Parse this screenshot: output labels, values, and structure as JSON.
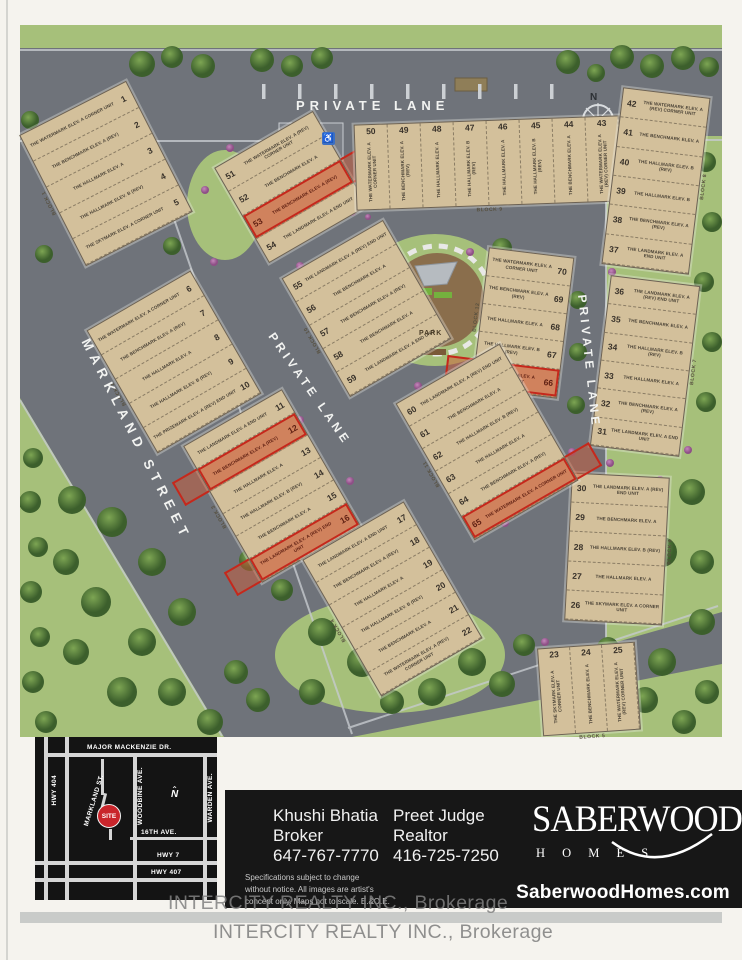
{
  "map": {
    "streets": {
      "private_lane_top": "PRIVATE LANE",
      "markland_street": "MARKLAND STREET",
      "private_lane_center": "PRIVATE LANE",
      "private_lane_right": "PRIVATE LANE"
    },
    "park_label": "PARK",
    "compass_label": "N",
    "blocks": [
      {
        "id": "b1",
        "label": "BLOCK 1",
        "lots": [
          {
            "n": "1",
            "model": "THE WATERMARK ELEV. A CORNER UNIT"
          },
          {
            "n": "2",
            "model": "THE BENCHMARK ELEV. A (REV)"
          },
          {
            "n": "3",
            "model": "THE HALLMARK ELEV. A"
          },
          {
            "n": "4",
            "model": "THE HALLMARK ELEV. B (REV)"
          },
          {
            "n": "5",
            "model": "THE SKYMARK ELEV. A CORNER UNIT"
          }
        ]
      },
      {
        "id": "b10",
        "label": "",
        "lots": [
          {
            "n": "51",
            "model": "THE WATERMARK ELEV. A (REV) CORNER UNIT"
          },
          {
            "n": "52",
            "model": "THE BENCHMARK ELEV. A"
          },
          {
            "n": "53",
            "model": "THE BENCHMARK ELEV. A (REV)",
            "hl": true
          },
          {
            "n": "54",
            "model": "THE LANDMARK ELEV. A END UNIT"
          }
        ]
      },
      {
        "id": "b9",
        "label": "BLOCK 9",
        "lots": [
          {
            "n": "50",
            "model": "THE WATERMARK ELEV. A CORNER UNIT"
          },
          {
            "n": "49",
            "model": "THE BENCHMARK ELEV. A (REV)"
          },
          {
            "n": "48",
            "model": "THE HALLMARK ELEV. A"
          },
          {
            "n": "47",
            "model": "THE HALLMARK ELEV. B (REV)"
          },
          {
            "n": "46",
            "model": "THE HALLMARK ELEV. A"
          },
          {
            "n": "45",
            "model": "THE HALLMARK ELEV. B (REV)"
          },
          {
            "n": "44",
            "model": "THE BENCHMARK ELEV. A"
          },
          {
            "n": "43",
            "model": "THE WATERMARK ELEV. A (REV) CORNER UNIT"
          }
        ]
      },
      {
        "id": "b6",
        "label": "BLOCK 8",
        "lots": [
          {
            "n": "42",
            "model": "THE WATERMARK ELEV. A (REV) CORNER UNIT"
          },
          {
            "n": "41",
            "model": "THE BENCHMARK ELEV. A"
          },
          {
            "n": "40",
            "model": "THE HALLMARK ELEV. B (REV)"
          },
          {
            "n": "39",
            "model": "THE HALLMARK ELEV. B"
          },
          {
            "n": "38",
            "model": "THE BENCHMARK ELEV. A (REV)"
          },
          {
            "n": "37",
            "model": "THE LANDMARK ELEV. A END UNIT"
          }
        ]
      },
      {
        "id": "b12",
        "label": "BLOCK 12",
        "lots": [
          {
            "n": "70",
            "model": "THE WATERMARK ELEV. A CORNER UNIT"
          },
          {
            "n": "69",
            "model": "THE BENCHMARK ELEV. A (REV)"
          },
          {
            "n": "68",
            "model": "THE HALLMARK ELEV. A"
          },
          {
            "n": "67",
            "model": "THE HALLMARK ELEV. B (REV)"
          },
          {
            "n": "66",
            "model": "THE SKYMARK ELEV. A CORNER UNIT",
            "hl": true
          }
        ]
      },
      {
        "id": "b7",
        "label": "BLOCK 7",
        "lots": [
          {
            "n": "36",
            "model": "THE LANDMARK ELEV. A (REV) END UNIT"
          },
          {
            "n": "35",
            "model": "THE BENCHMARK ELEV. A"
          },
          {
            "n": "34",
            "model": "THE HALLMARK ELEV. B (REV)"
          },
          {
            "n": "33",
            "model": "THE HALLMARK ELEV. A"
          },
          {
            "n": "32",
            "model": "THE BENCHMARK ELEV. A (REV)"
          },
          {
            "n": "31",
            "model": "THE LANDMARK ELEV. A END UNIT"
          }
        ]
      },
      {
        "id": "b8",
        "label": "BLOCK 6",
        "lots": [
          {
            "n": "30",
            "model": "THE LANDMARK ELEV. A (REV) END UNIT"
          },
          {
            "n": "29",
            "model": "THE BENCHMARK ELEV. A"
          },
          {
            "n": "28",
            "model": "THE HALLMARK ELEV. B (REV)"
          },
          {
            "n": "27",
            "model": "THE HALLMARK ELEV. A"
          },
          {
            "n": "26",
            "model": "THE SKYMARK ELEV. A CORNER UNIT"
          }
        ]
      },
      {
        "id": "b2",
        "label": "BLOCK 2",
        "lots": [
          {
            "n": "6",
            "model": "THE WATERMARK ELEV. A CORNER UNIT"
          },
          {
            "n": "7",
            "model": "THE BENCHMARK ELEV. A (REV)"
          },
          {
            "n": "8",
            "model": "THE HALLMARK ELEV. A"
          },
          {
            "n": "9",
            "model": "THE HALLMARK ELEV. B (REV)"
          },
          {
            "n": "10",
            "model": "THE PRIZEMARK ELEV. A (REV) END UNIT"
          }
        ]
      },
      {
        "id": "b55",
        "label": "BLOCK 10",
        "lots": [
          {
            "n": "55",
            "model": "THE LANDMARK ELEV. A (REV) END UNIT"
          },
          {
            "n": "56",
            "model": "THE BENCHMARK ELEV. A"
          },
          {
            "n": "57",
            "model": "THE BENCHMARK ELEV. A (REV)"
          },
          {
            "n": "58",
            "model": "THE BENCHMARK ELEV. A"
          },
          {
            "n": "59",
            "model": "THE LANDMARK ELEV. A END UNIT"
          }
        ]
      },
      {
        "id": "b3",
        "label": "BLOCK 3",
        "lots": [
          {
            "n": "11",
            "model": "THE LANDMARK ELEV. A END UNIT"
          },
          {
            "n": "12",
            "model": "THE BENCHMARK ELEV. A (REV)",
            "hl": true
          },
          {
            "n": "13",
            "model": "THE HALLMARK ELEV. A"
          },
          {
            "n": "14",
            "model": "THE HALLMARK ELEV. B (REV)"
          },
          {
            "n": "15",
            "model": "THE BENCHMARK ELEV. A"
          },
          {
            "n": "16",
            "model": "THE LANDMARK ELEV. A (REV) END UNIT",
            "hl": true
          }
        ]
      },
      {
        "id": "b11",
        "label": "BLOCK 11",
        "lots": [
          {
            "n": "60",
            "model": "THE LANDMARK ELEV. A (REV) END UNIT"
          },
          {
            "n": "61",
            "model": "THE BENCHMARK ELEV. A"
          },
          {
            "n": "62",
            "model": "THE HALLMARK ELEV. B (REV)"
          },
          {
            "n": "63",
            "model": "THE HALLMARK ELEV. A"
          },
          {
            "n": "64",
            "model": "THE BENCHMARK ELEV. A (REV)"
          },
          {
            "n": "65",
            "model": "THE WATERMARK ELEV. A CORNER UNIT",
            "hl": true
          }
        ]
      },
      {
        "id": "b4",
        "label": "BLOCK 4",
        "lots": [
          {
            "n": "17",
            "model": "THE LANDMARK ELEV. A END UNIT"
          },
          {
            "n": "18",
            "model": "THE BENCHMARK ELEV. A (REV)"
          },
          {
            "n": "19",
            "model": "THE HALLMARK ELEV. A"
          },
          {
            "n": "20",
            "model": "THE HALLMARK ELEV. B (REV)"
          },
          {
            "n": "21",
            "model": "THE BENCHMARK ELEV. A"
          },
          {
            "n": "22",
            "model": "THE WATERMARK ELEV. A (REV) CORNER UNIT"
          }
        ]
      },
      {
        "id": "b5",
        "label": "BLOCK 5",
        "lots": [
          {
            "n": "23",
            "model": "THE SKYMARK ELEV. A CORNER UNIT"
          },
          {
            "n": "24",
            "model": "THE BENCHMARK ELEV. A"
          },
          {
            "n": "25",
            "model": "THE WATERMARK ELEV. A (REV) CORNER UNIT"
          }
        ]
      }
    ]
  },
  "inset_map": {
    "roads": {
      "major_mackenzie": "MAJOR  MACKENZIE  DR.",
      "hwy_404": "HWY 404",
      "markland": "MARKLAND ST.",
      "woodbine": "WOODBINE AVE.",
      "warden": "WARDEN AVE.",
      "sixteenth": "16TH AVE.",
      "hwy_7": "HWY 7",
      "hwy_407": "HWY 407"
    },
    "site_label": "SITE",
    "compass_label": "N"
  },
  "agents": [
    {
      "name": "Khushi Bhatia",
      "title": "Broker",
      "phone": "647-767-7770"
    },
    {
      "name": "Preet Judge",
      "title": "Realtor",
      "phone": "416-725-7250"
    }
  ],
  "disclaimer": [
    "Specifications subject to change",
    "without notice. All images are artist's",
    "concept only. Maps not to scale.  E.&O.E."
  ],
  "brand": {
    "name": "SABERWOOD",
    "sub": "H O M E S",
    "website": "SaberwoodHomes.com"
  },
  "watermark": "INTERCITY REALTY INC., Brokerage",
  "colors": {
    "lot_tan": "#d3c09b",
    "road_gray": "#6f737a",
    "grass_green": "#a6c07a",
    "highlight_red": "#c5281c",
    "site_red": "#c9252b",
    "panel_black": "#171717"
  }
}
